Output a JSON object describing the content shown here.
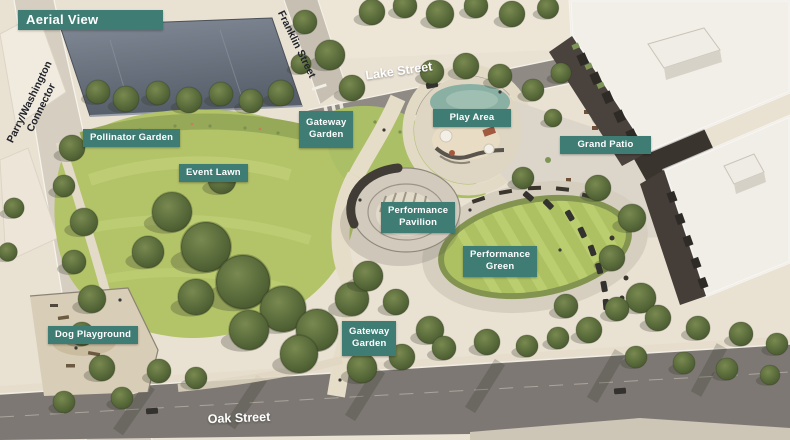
{
  "header": {
    "title": "Aerial View"
  },
  "colors": {
    "label_bg": "#3E7C74",
    "label_text": "#FFFFFF",
    "street_text_dark": "#22242C",
    "street_text_light": "#FFFFFF"
  },
  "street_labels": {
    "parry_washington": "Parry/Washington\nConnector",
    "franklin": "Franklin Street",
    "lake": "Lake Street",
    "oak": "Oak Street"
  },
  "area_labels": [
    {
      "id": "pollinator-garden",
      "text": "Pollinator Garden"
    },
    {
      "id": "event-lawn",
      "text": "Event Lawn"
    },
    {
      "id": "gateway-garden-north",
      "text": "Gateway\nGarden"
    },
    {
      "id": "play-area",
      "text": "Play Area"
    },
    {
      "id": "grand-patio",
      "text": "Grand Patio"
    },
    {
      "id": "performance-pavilion",
      "text": "Performance\nPavilion"
    },
    {
      "id": "performance-green",
      "text": "Performance\nGreen"
    },
    {
      "id": "dog-playground",
      "text": "Dog Playground"
    },
    {
      "id": "gateway-garden-south",
      "text": "Gateway\nGarden"
    }
  ]
}
